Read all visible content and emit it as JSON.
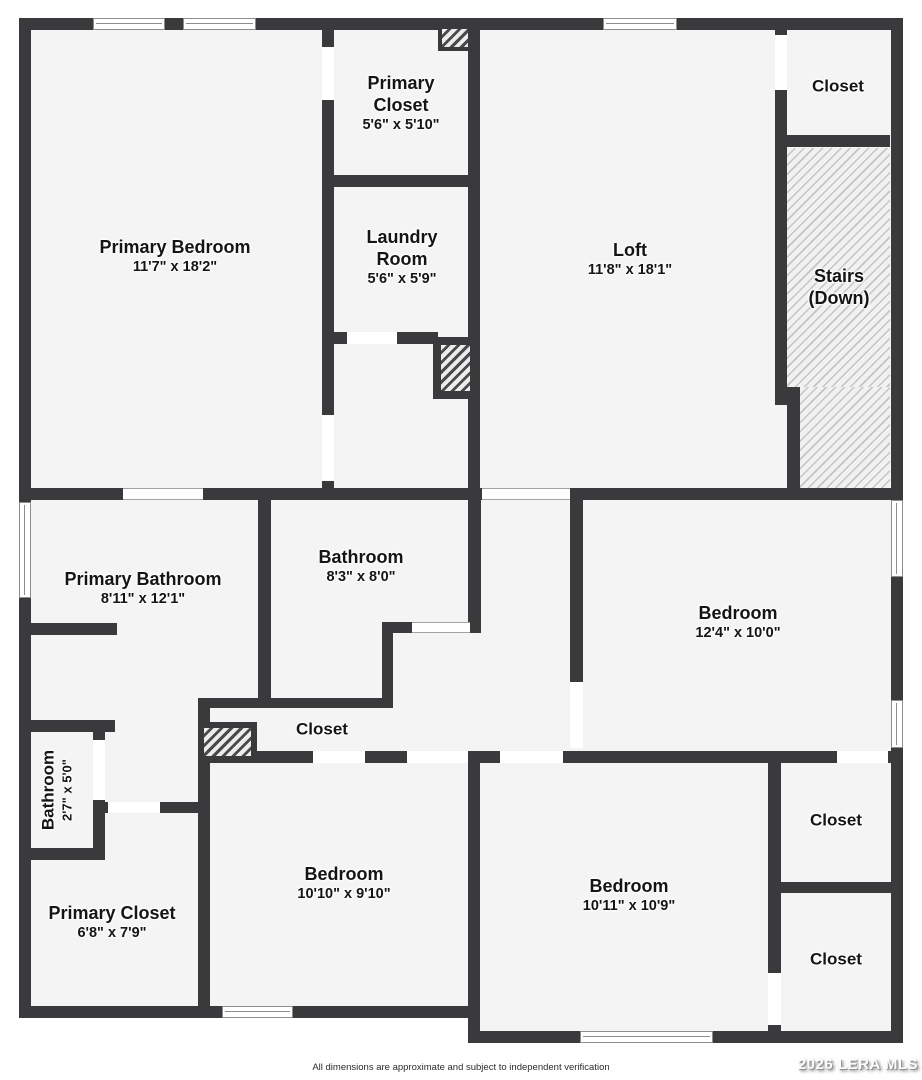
{
  "rooms": {
    "primary_bedroom": {
      "name": "Primary Bedroom",
      "dims": "11'7\" x 18'2\""
    },
    "primary_closet_top": {
      "name": "Primary Closet",
      "dims": "5'6\" x 5'10\""
    },
    "laundry": {
      "name": "Laundry Room",
      "dims": "5'6\" x 5'9\""
    },
    "loft": {
      "name": "Loft",
      "dims": "11'8\" x 18'1\""
    },
    "closet_top_right": {
      "name": "Closet"
    },
    "stairs": {
      "name": "Stairs (Down)"
    },
    "primary_bathroom": {
      "name": "Primary Bathroom",
      "dims": "8'11\" x 12'1\""
    },
    "bathroom": {
      "name": "Bathroom",
      "dims": "8'3\" x 8'0\""
    },
    "bedroom_east": {
      "name": "Bedroom",
      "dims": "12'4\" x 10'0\""
    },
    "closet_middle": {
      "name": "Closet"
    },
    "bathroom_small": {
      "name": "Bathroom",
      "dims": "2'7\" x 5'0\""
    },
    "primary_closet_bottom": {
      "name": "Primary Closet",
      "dims": "6'8\" x 7'9\""
    },
    "bedroom_southwest": {
      "name": "Bedroom",
      "dims": "10'10\" x 9'10\""
    },
    "bedroom_southeast": {
      "name": "Bedroom",
      "dims": "10'11\" x 10'9\""
    },
    "closet_right_upper": {
      "name": "Closet"
    },
    "closet_right_lower": {
      "name": "Closet"
    }
  },
  "footer": {
    "disclaimer": "All dimensions are approximate and subject to independent verification",
    "watermark": "2026 LERA MLS"
  },
  "colors": {
    "wall": "#3a3a3c",
    "room_fill": "#f4f4f4",
    "text": "#151515"
  }
}
